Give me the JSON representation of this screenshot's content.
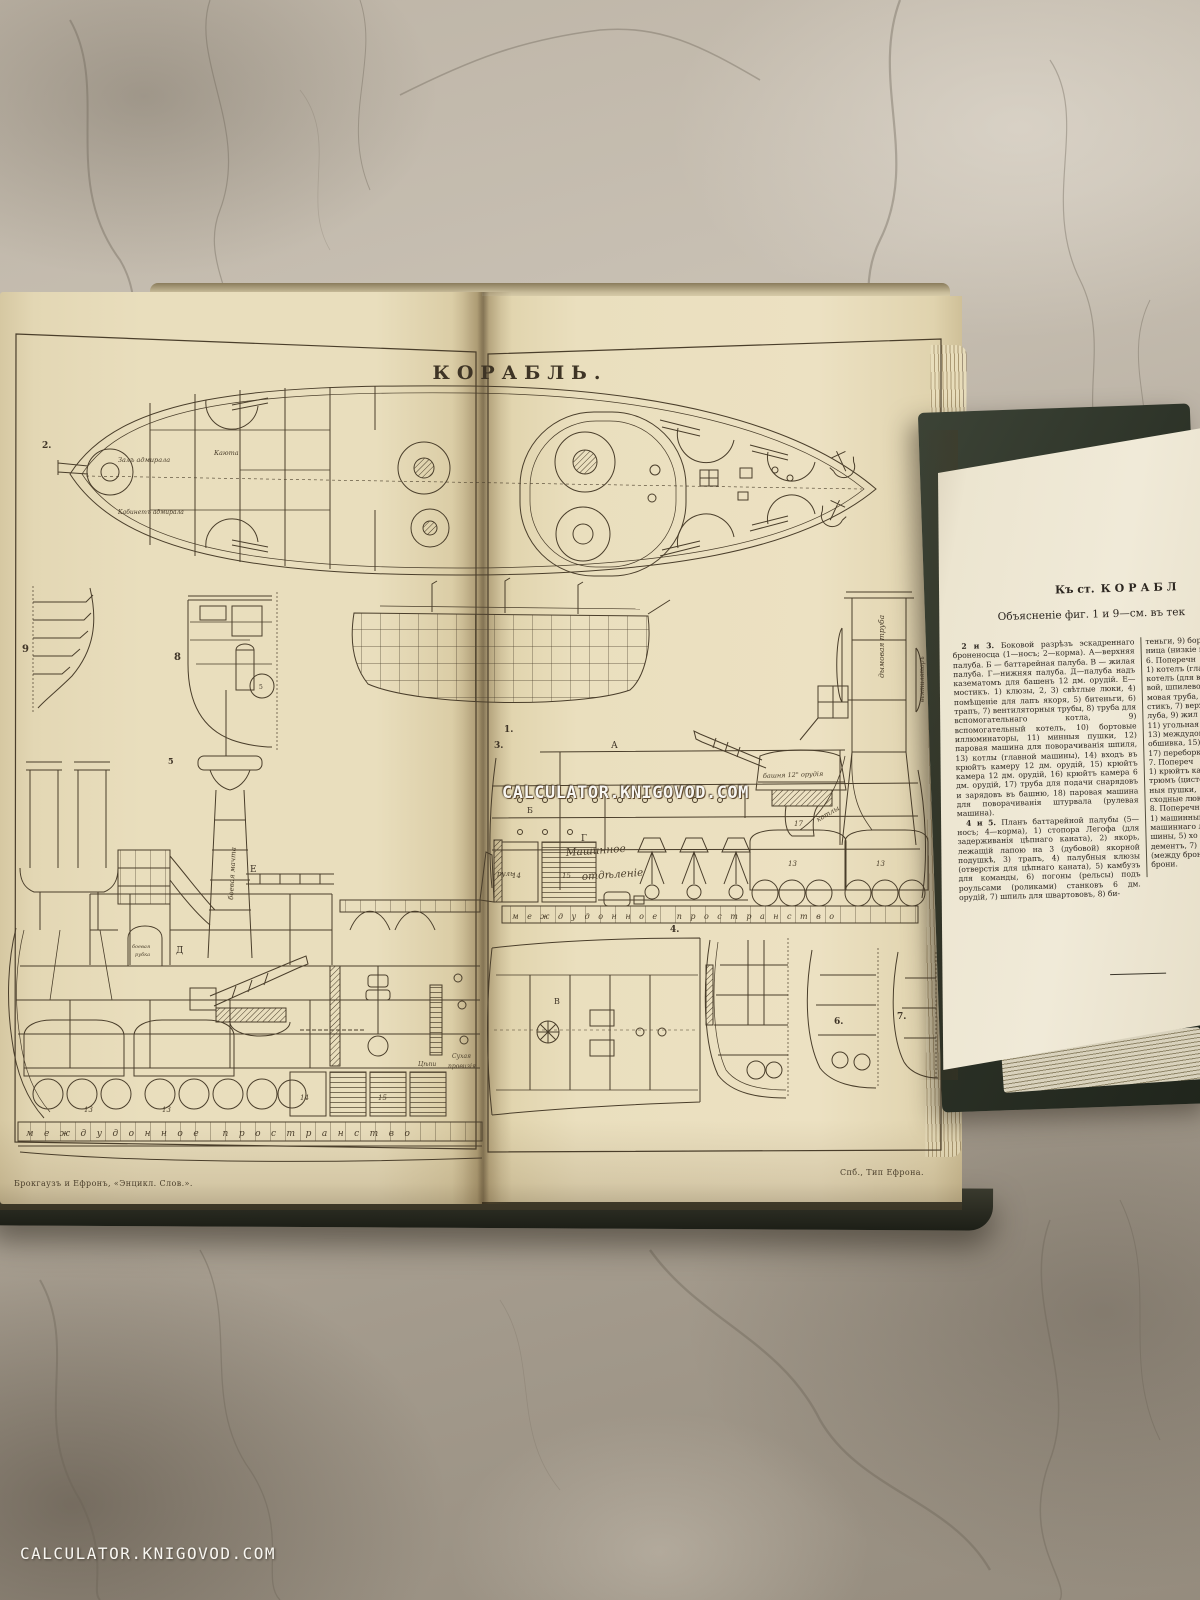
{
  "watermarks": {
    "center": "CALCULATOR.KNIGOVOD.COM",
    "corner": "CALCULATOR.KNIGOVOD.COM"
  },
  "plate": {
    "title": "КОРАБЛЬ.",
    "imprint_left": "Брокгаузъ и Ефронъ, «Энцикл. Слов.».",
    "imprint_right": "Спб., Тип Ефрона.",
    "figures": {
      "f1": "1.",
      "f2": "2.",
      "f3": "3.",
      "f4": "4.",
      "f5": "5",
      "f6": "6.",
      "f7": "7.",
      "f8": "8",
      "f9": "9"
    },
    "parts": {
      "p13a": "13",
      "p13b": "13",
      "p13c": "13",
      "p13d": "13",
      "p14a": "14",
      "p14b": "14",
      "p15a": "15",
      "p15b": "15",
      "p17": "17",
      "p5": "5"
    },
    "deck_letters": {
      "a": "А",
      "b": "Б",
      "v": "В",
      "g": "Г",
      "d": "Д",
      "e": "Е"
    },
    "labels": {
      "admiral_hall": "Залъ адмирала",
      "admiral_cabinet": "Кабинетъ адмирала",
      "cabin": "Каюта",
      "engine_room_line1": "Машинное",
      "engine_room_line2": "отдѣленіе",
      "turret_gun": "башня 12\" орудія",
      "funnel": "дымовая труба",
      "ventilator": "вентиляторъ",
      "conning_tower_line1": "боевая",
      "conning_tower_line2": "рубка",
      "fighting_mast": "боевая мачта",
      "rudder": "руль",
      "boilers": "котлы",
      "chains": "Цѣпи",
      "dry_provisions_line1": "Сухая",
      "dry_provisions_line2": "провизія",
      "double_bottom": "междудонное пространство"
    }
  },
  "booklet": {
    "header_prefix": "Къ ст.",
    "header_word": "КОРАБЛ",
    "subheader": "Объясненіе фиг. 1 и 9—см. въ тек",
    "paragraphs": [
      {
        "num": "2 и 3.",
        "text": " Боковой разрѣзъ эскадреннаго броненосца (1—носъ; 2—корма). А—верхняя палуба. Б — баттарейная палуба. В — жилая палуба. Г—нижняя палуба. Д—палуба надъ казематомъ для башенъ 12 дм. орудій. Е—мостикъ. 1) клюзы, 2, 3) свѣтлые люки, 4) помѣщеніе для лапъ якоря, 5) битеньги, 6) трапъ, 7) вентиляторныя трубы, 8) труба для вспомогательнаго котла, 9) вспомогательный котелъ, 10) бортовые иллюминаторы, 11) минныя пушки, 12) паровая машина для поворачиванія шпиля, 13) котлы (главной машины), 14) входъ въ крюйтъ камеру 12 дм. орудій, 15) крюйтъ камера 12 дм. орудій, 16) крюйтъ камера 6 дм. орудій, 17) труба для подачи снарядовъ и зарядовъ въ башню, 18) паровая машина для поворачиванія штурвала (рулевая машина)."
      },
      {
        "num": "4 и 5.",
        "text": " Планъ баттарейной палубы (5—носъ; 4—корма), 1) стопора Легофа (для задерживанія цѣпнаго каната), 2) якорь, лежащій лапою на 3 (дубовой) якорной подушкѣ, 3) трапъ, 4) палубныя клюзы (отверстія для цѣпнаго каната), 5) камбузъ для команды, 6) погоны (рельсы) подъ роульсами (роликами) станковъ 6 дм. орудій, 7) шпиль для швартововъ, 8) би-"
      }
    ],
    "right_column": "теньги, 9) борт\nница (низкіе ш\n6. Поперечн\n1) котелъ (главн\nкотелъ (для всп\nвой, шпилевой\nмовая труба,\nстикъ, 7) верх\nлуба, 9) жил\n11) угольная\n13) междудон\nобшивка, 15)\n17) переборка\n7. Попереч\n1) крюйтъ кам\nтрюмъ (цистер\nныя пушки,\nсходные люки\n8. Поперечн\n1) машинный\nмашиннаго лю\nшины, 5) хо\nдементъ, 7)\n(между брон\nброни."
  },
  "palette": {
    "marble": "#b6ad9f",
    "atlas_page": "#e9debd",
    "booklet_page": "#f0ead8",
    "book_cover": "#2c3227",
    "ink": "#4a3e2b",
    "watermark": "#f8f6f1"
  }
}
